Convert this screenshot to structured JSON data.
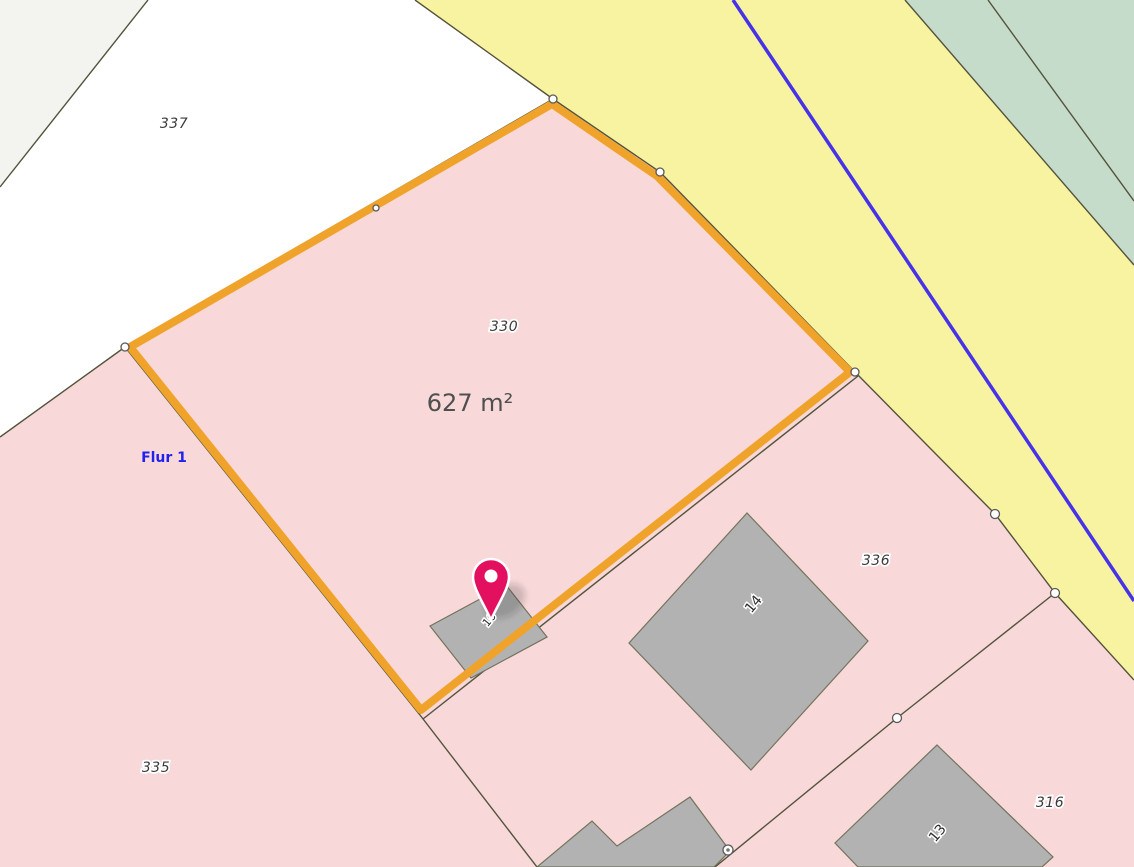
{
  "map": {
    "width": 1134,
    "height": 867,
    "colors": {
      "white": "#FFFFFF",
      "offwhite": "#F3F3F0",
      "pink": "#F8D8D9",
      "yellow": "#F8F3A1",
      "green": "#C5DCCB",
      "building": "#B2B2B2",
      "building_border": "#73735C",
      "boundary": "#53533C",
      "highlight": "#F0A32B",
      "water": "#4633E8",
      "pin": "#E31060",
      "vertex_stroke": "#5A5A5A"
    },
    "regions": [
      {
        "name": "parcel-offwhite-corner",
        "points": "0,0 148,0 0,187",
        "fill": "offwhite"
      },
      {
        "name": "parcel-335",
        "points": "0,437 125,347 420,715 537,867 0,867",
        "fill": "pink"
      },
      {
        "name": "parcel-330-highlighted",
        "points": "553,99 660,172 855,372 420,715 125,347",
        "fill": "pink"
      },
      {
        "name": "parcel-336-316",
        "points": "855,372 995,514 1055,593 1134,680 1134,867 537,867 420,715",
        "fill": "pink"
      },
      {
        "name": "road-area",
        "points": "415,0 905,0 1134,265 1134,680 1055,593 995,514 855,372 660,172 553,99",
        "fill": "yellow"
      },
      {
        "name": "green-area",
        "points": "905,0 1134,0 1134,265",
        "fill": "green"
      }
    ],
    "boundaries": [
      {
        "name": "boundary-337-west",
        "points": "148,0 0,187"
      },
      {
        "name": "boundary-road-west",
        "points": "415,0 553,99 660,172 855,372 995,514 1055,593 1134,680"
      },
      {
        "name": "boundary-road-green",
        "points": "905,0 1134,265"
      },
      {
        "name": "boundary-green-inner",
        "points": "988,0 1134,201"
      },
      {
        "name": "boundary-337-335",
        "points": "125,347 0,437"
      },
      {
        "name": "boundary-330-northwest",
        "points": "553,99 125,347"
      },
      {
        "name": "boundary-330-southwest",
        "points": "125,347 420,715"
      },
      {
        "name": "boundary-335-southeast",
        "points": "420,715 537,867"
      },
      {
        "name": "boundary-330-southeast",
        "points": "858,376 423,719"
      },
      {
        "name": "boundary-336-316",
        "points": "1055,593 897,718 715,867"
      }
    ],
    "water_line": {
      "name": "stream-line",
      "points": "733,0 1134,601"
    },
    "buildings": [
      {
        "name": "building-16",
        "points": "430,626 506,585 547,637 471,678"
      },
      {
        "name": "building-14",
        "points": "747,513 868,641 751,770 629,643"
      },
      {
        "name": "building-13",
        "points": "937,745 1053,857 1042,867 858,867 835,843"
      },
      {
        "name": "building-complex-south",
        "points": "592,821 617,846 690,797 730,851 714,867 537,867"
      }
    ],
    "highlight": {
      "name": "selected-parcel-outline",
      "points": "552,104 657,176 850,372 421,710 130,347",
      "width": 8
    },
    "vertices": [
      {
        "x": 553,
        "y": 99,
        "r": 4
      },
      {
        "x": 660,
        "y": 172,
        "r": 4
      },
      {
        "x": 855,
        "y": 372,
        "r": 4
      },
      {
        "x": 125,
        "y": 347,
        "r": 4
      },
      {
        "x": 376,
        "y": 208,
        "r": 3
      },
      {
        "x": 995,
        "y": 514,
        "r": 4.5
      },
      {
        "x": 1055,
        "y": 593,
        "r": 4.5
      },
      {
        "x": 897,
        "y": 718,
        "r": 4.5
      },
      {
        "x": 728,
        "y": 850,
        "r": 5,
        "inner": true
      }
    ],
    "labels": [
      {
        "name": "parcel-label-337",
        "text": "337",
        "x": 174,
        "y": 128,
        "class": "parcel-label"
      },
      {
        "name": "parcel-label-330",
        "text": "330",
        "x": 504,
        "y": 331,
        "class": "parcel-label"
      },
      {
        "name": "parcel-label-336",
        "text": "336",
        "x": 876,
        "y": 565,
        "class": "parcel-label"
      },
      {
        "name": "parcel-label-316",
        "text": "316",
        "x": 1050,
        "y": 807,
        "class": "parcel-label"
      },
      {
        "name": "parcel-label-335",
        "text": "335",
        "x": 156,
        "y": 772,
        "class": "parcel-label"
      },
      {
        "name": "building-label-14",
        "text": "14",
        "x": 757,
        "y": 607,
        "class": "building-label",
        "rotation": -50
      },
      {
        "name": "building-label-13",
        "text": "13",
        "x": 941,
        "y": 836,
        "class": "building-label",
        "rotation": -50
      },
      {
        "name": "building-label-16",
        "text": "16",
        "x": 492,
        "y": 622,
        "class": "building-label small",
        "rotation": -50
      },
      {
        "name": "area-label",
        "text": "627 m²",
        "x": 470,
        "y": 411,
        "class": "area-label"
      },
      {
        "name": "flur-label",
        "text": "Flur 1",
        "x": 164,
        "y": 462,
        "class": "flur-label"
      }
    ],
    "pin": {
      "name": "location-pin",
      "x": 491,
      "y": 577,
      "tip_y": 620,
      "r": 18,
      "hole_r": 6.5,
      "shadow": {
        "cx": 505,
        "cy": 601,
        "rx": 22,
        "ry": 15,
        "rotation": -33
      }
    }
  }
}
